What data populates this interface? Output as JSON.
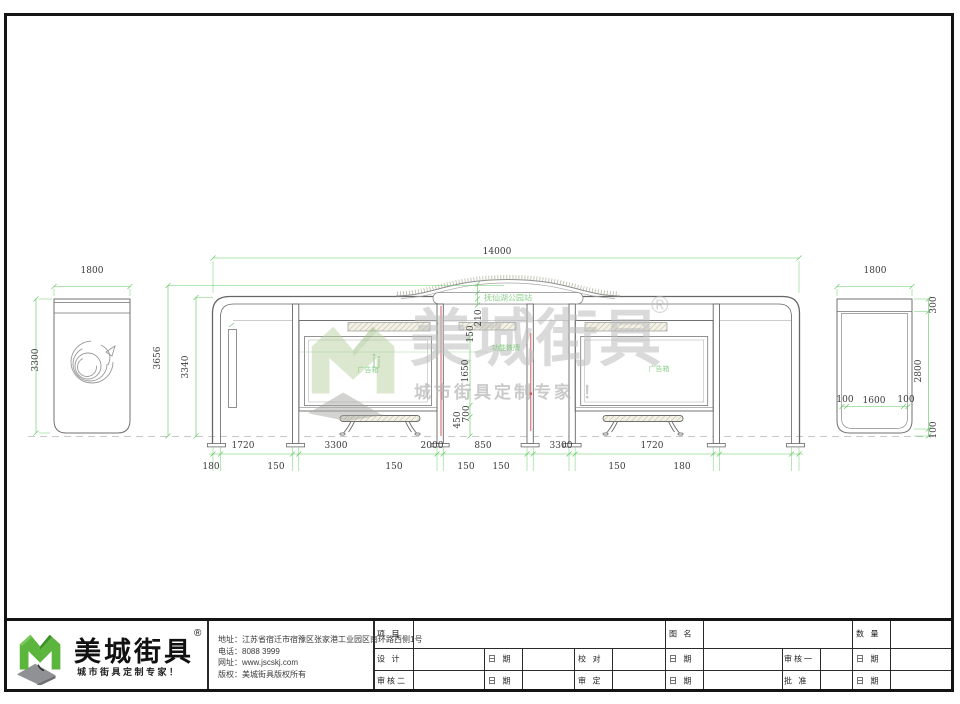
{
  "colors": {
    "frame": "#141414",
    "line": "#6e6e6e",
    "dim_line_green": "#5fc75f",
    "dim_text": "#3a3a3a",
    "label_green": "#7cc87c",
    "accent_red": "#d24a4a",
    "watermark_gray": "#bdbdbd",
    "logo_green": "#5cb53c"
  },
  "watermark": {
    "brand": "美城街具",
    "registered": "®",
    "slogan": "城市街具定制专家 ！"
  },
  "front": {
    "dim_total": "14000",
    "dim_height_outer": "3656",
    "dim_height_inner": "3340",
    "dims_mid": [
      "210",
      "150",
      "1650",
      "700",
      "450"
    ],
    "dims_gaps": [
      "1720",
      "3300",
      "2000",
      "850",
      "3300",
      "1720"
    ],
    "dims_posts": [
      "180",
      "150",
      "150",
      "150",
      "150",
      "150",
      "180"
    ],
    "roof_sign": "抚仙湖公园站",
    "label_center": "功能铁牌",
    "label_ad_left": "广告箱",
    "label_ad_right": "广告箱"
  },
  "left_view": {
    "dim_width": "1800",
    "dim_height": "3300"
  },
  "right_view": {
    "dim_width": "1800",
    "dim_top": "300",
    "dim_height": "2800",
    "dim_ground": "100",
    "dim_inner": [
      "100",
      "1600",
      "100"
    ]
  },
  "title_block": {
    "logo_brand": "美城街具",
    "logo_registered": "®",
    "logo_slogan": "城市街具定制专家！",
    "info": [
      {
        "label": "地址：",
        "value": "江苏省宿迁市宿豫区张家港工业园区南环路西侧1号"
      },
      {
        "label": "电话：",
        "value": "8088 3999"
      },
      {
        "label": "网址：",
        "value": "www.jscskj.com"
      },
      {
        "label": "版权：",
        "value": "美城街具版权所有"
      }
    ],
    "table": {
      "row1": [
        "项 目",
        "图 名",
        "数 量"
      ],
      "row2": [
        "设 计",
        "日 期",
        "校 对",
        "日 期",
        "审核一",
        "日 期"
      ],
      "row3": [
        "审核二",
        "日 期",
        "审 定",
        "日 期",
        "批 准",
        "日 期"
      ]
    }
  }
}
